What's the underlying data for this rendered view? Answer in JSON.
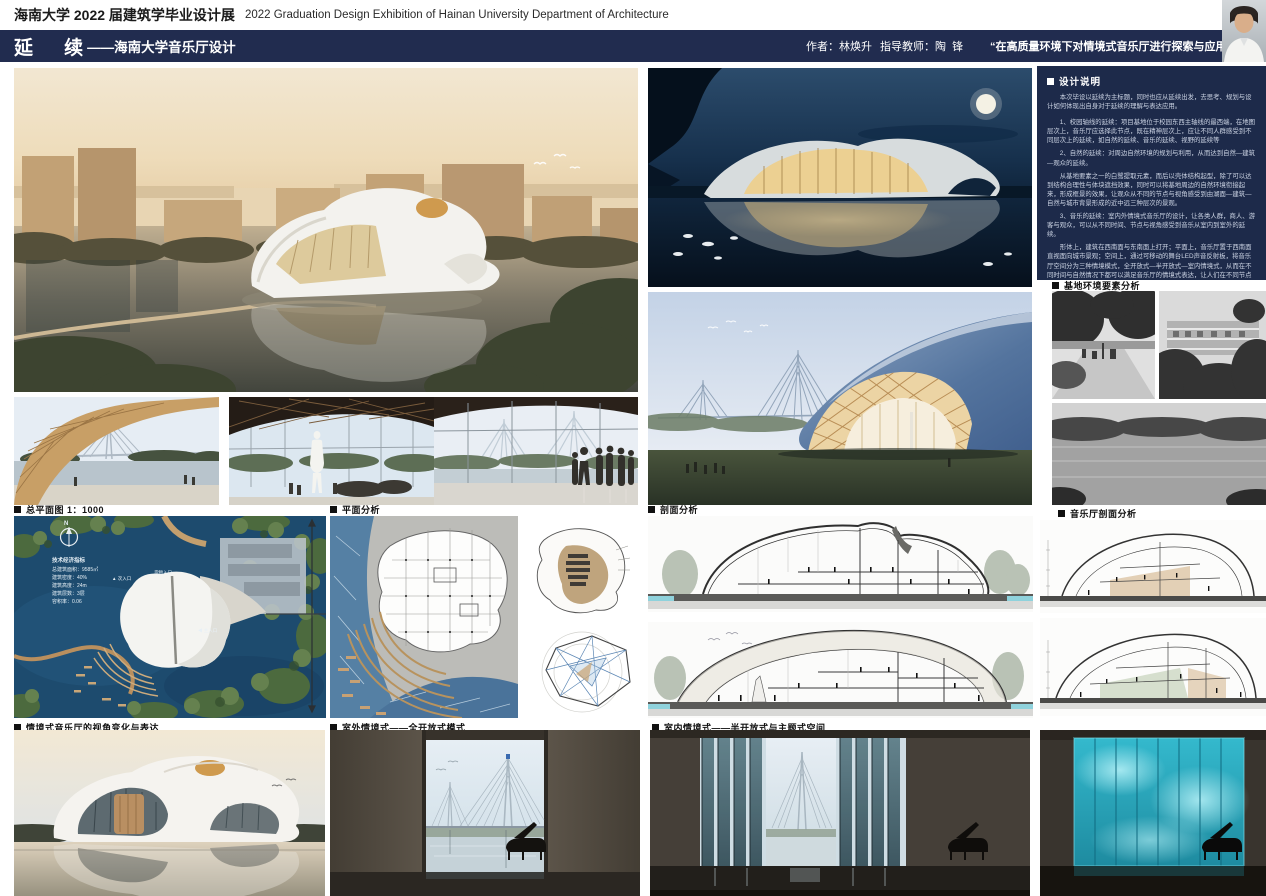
{
  "header": {
    "title_cn": "海南大学 2022 届建筑学毕业设计展",
    "title_en": "2022 Graduation Design Exhibition of Hainan University Department of Architecture"
  },
  "title_bar": {
    "title_main": "延    续",
    "title_sub": "——海南大学音乐厅设计",
    "author": "作者：林焕升",
    "advisor": "指导教师：陶  锋",
    "quote": "“在高质量环境下对情境式音乐厅进行探索与应用”"
  },
  "design_notes": {
    "heading": "设计说明",
    "intro": "本次毕设以延续为主标题，同时也应从延续出发，去思考、规划与设计如何体现出自身对于延续的理解与表达应用。",
    "p1": "1、校园轴线的延续：项目基地位于校园东西主轴线的最西端，在地图层次上，音乐厅应选择此节点，既在精神层次上，应让不同人群感受到不同层次上的延续，如自然的延续、音乐的延续、视野的延续等",
    "p2": "2、自然的延续：对周边自然环境的规划与利用，从而达到自然—建筑—观众的延续。",
    "p3": "从基地要素之一的白鹭提取元素，而后以壳体结构起型，除了可以达到结构合理性与体块遮挡效果，同时可以将基地周边的自然环境衔接起来，形成框景的效果，让观众从不同的节点与视角感受到由湖面—建筑—自然与城市背景形成的近中远三种层次的景观。",
    "p4": "3、音乐的延续：室内外情境式音乐厅的设计，让各类人群，商人、游客与观众，可以从不同时间、节点与视角感受到音乐从室内到室外的延续。",
    "p5": "形体上，建筑在西南面与东南面上打开；平面上，音乐厅置于西南面直视面向城市景观；空间上，通过可移动的舞台LED声音反射板，将音乐厅空间分为三种情境模式，全开放式—半开放式—室内情境式，从而在不同时间与自然情况下都可以满足音乐厅的情境式表达，让人们在不同节点与视角感受到音乐从室内到室外的延续。",
    "p6": "总的来说，从城市—建筑—人群的整体关系入手，通过对延续的理解，进行上述三点从物质到精神层次上的延续的空间与表达，完成了对空间规划，而后通过合适的结构体系—壳结构与空间结合，将建筑设立起来，完成了建筑从内到外体系的完全确定，从而在空间与形体上，和谐统一且满足各类人群的需求，从而完成对延续标题的表达。"
  },
  "section_labels": {
    "site_env": "基地环境要素分析",
    "site_plan": "总平面图 1：1000",
    "plan_analysis": "平面分析",
    "section_analysis": "剖面分析",
    "hall_section": "音乐厅剖面分析",
    "perspective": "情境式音乐厅的视角变化与表达",
    "outdoor_mode": "室外情境式——全开放式模式",
    "indoor_mode": "室内情境式——半开放式与主题式空间"
  },
  "site_plan": {
    "north": "N",
    "indicators_title": "技术经济指标",
    "ind1": "总建筑面积：9585㎡",
    "ind2": "建筑密度：40%",
    "ind3": "建筑高度：24m",
    "ind4": "建筑层数：3层",
    "ind5": "容积率：0.06",
    "entrance_main": "◀ 主入口",
    "entrance_secondary": "▲ 次入口",
    "entrance_service": "货物入口"
  },
  "colors": {
    "navy_bar": "#212c4f",
    "notes_panel": "#1d2a4a",
    "led_teal": "#3cc8d8",
    "timber": "#caa46e"
  }
}
